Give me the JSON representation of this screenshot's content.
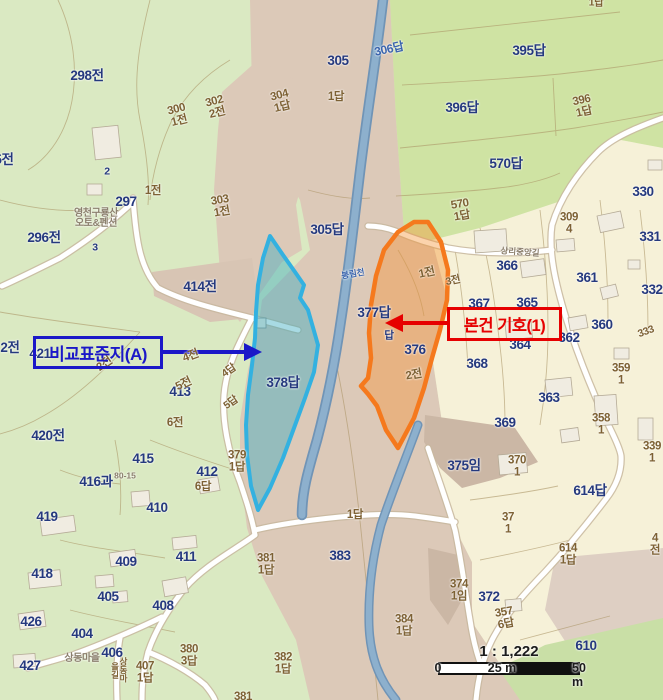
{
  "colors": {
    "navy": "#25397e",
    "brown": "#7d6134",
    "grayLabel": "#8b7f6d",
    "riverLabel": "#3a64ad",
    "calloutBlue": "#1b18c8",
    "calloutRed": "#e60000",
    "highlightOrange": "#f5791d",
    "highlightCyan": "#33b1e0",
    "paddyGreen": "#cfe3a3",
    "fieldGreen": "#dae9c2",
    "valleyTan": "#dcc9b8",
    "villageCream": "#f6f1d8",
    "riverBlue": "#84a8c6"
  },
  "callouts": {
    "comparison": {
      "label": "비교표준지(A)"
    },
    "subject": {
      "label": "본건 기호(1)"
    }
  },
  "scalebar": {
    "ratio": "1 : 1,222",
    "ticks": [
      "0",
      "25 m",
      "50 m"
    ]
  },
  "map": {
    "labels": [
      {
        "t": "298전",
        "x": 87,
        "y": 76
      },
      {
        "t": "305",
        "x": 338,
        "y": 61
      },
      {
        "t": "1답",
        "x": 336,
        "y": 98,
        "k": "brown"
      },
      {
        "t": "304\n1답",
        "x": 281,
        "y": 102,
        "k": "brown",
        "r": -14
      },
      {
        "t": "302\n2전",
        "x": 216,
        "y": 108,
        "k": "brown",
        "r": -14
      },
      {
        "t": "300\n1전",
        "x": 178,
        "y": 116,
        "k": "brown",
        "r": -14
      },
      {
        "t": "306답",
        "x": 389,
        "y": 49,
        "k": "blue",
        "r": -12
      },
      {
        "t": "395답",
        "x": 529,
        "y": 51
      },
      {
        "t": "396답",
        "x": 462,
        "y": 108
      },
      {
        "t": "396\n1답",
        "x": 583,
        "y": 107,
        "k": "brown",
        "r": -12
      },
      {
        "t": "570답",
        "x": 506,
        "y": 164
      },
      {
        "t": "570\n1답",
        "x": 461,
        "y": 211,
        "k": "brown",
        "r": -10
      },
      {
        "t": "1답",
        "x": 596,
        "y": 3,
        "k": "brown small"
      },
      {
        "t": "2",
        "x": 107,
        "y": 172,
        "k": "small"
      },
      {
        "t": "297",
        "x": 126,
        "y": 202
      },
      {
        "t": "1전",
        "x": 153,
        "y": 192,
        "k": "brown"
      },
      {
        "t": "303\n1전",
        "x": 221,
        "y": 207,
        "k": "brown",
        "r": -10
      },
      {
        "t": "영천구룡산\n오토&펜션",
        "x": 96,
        "y": 219,
        "k": "gray",
        "n": "pension-name-label"
      },
      {
        "t": "3",
        "x": 95,
        "y": 248,
        "k": "small"
      },
      {
        "t": "296전",
        "x": 44,
        "y": 238
      },
      {
        "t": "5전",
        "x": 4,
        "y": 160
      },
      {
        "t": "414전",
        "x": 200,
        "y": 287
      },
      {
        "t": "305답",
        "x": 327,
        "y": 230
      },
      {
        "t": "330",
        "x": 643,
        "y": 192
      },
      {
        "t": "331",
        "x": 650,
        "y": 237
      },
      {
        "t": "309\n4",
        "x": 569,
        "y": 224,
        "k": "brown"
      },
      {
        "t": "366",
        "x": 507,
        "y": 266
      },
      {
        "t": "361",
        "x": 587,
        "y": 278
      },
      {
        "t": "332",
        "x": 652,
        "y": 290
      },
      {
        "t": "367",
        "x": 479,
        "y": 304
      },
      {
        "t": "365",
        "x": 527,
        "y": 303
      },
      {
        "t": "377답",
        "x": 374,
        "y": 313
      },
      {
        "t": "1전",
        "x": 427,
        "y": 274,
        "k": "brown",
        "r": -12
      },
      {
        "t": "3전",
        "x": 453,
        "y": 281,
        "k": "brown small",
        "r": -12
      },
      {
        "t": "360",
        "x": 602,
        "y": 325
      },
      {
        "t": "333",
        "x": 646,
        "y": 332,
        "k": "brown small",
        "r": -20
      },
      {
        "t": "362",
        "x": 569,
        "y": 338
      },
      {
        "t": "364",
        "x": 520,
        "y": 345
      },
      {
        "t": "답",
        "x": 389,
        "y": 336,
        "k": "small"
      },
      {
        "t": "376",
        "x": 415,
        "y": 350
      },
      {
        "t": "368",
        "x": 477,
        "y": 364
      },
      {
        "t": "2전",
        "x": 414,
        "y": 376,
        "k": "brown",
        "r": -10
      },
      {
        "t": "359\n1",
        "x": 621,
        "y": 375,
        "k": "brown"
      },
      {
        "t": "378답",
        "x": 283,
        "y": 383
      },
      {
        "t": "363",
        "x": 549,
        "y": 398
      },
      {
        "t": "421",
        "x": 40,
        "y": 354
      },
      {
        "t": "2전",
        "x": 10,
        "y": 348
      },
      {
        "t": "2전",
        "x": 105,
        "y": 365,
        "k": "brown",
        "r": -35
      },
      {
        "t": "4전",
        "x": 191,
        "y": 357,
        "k": "brown",
        "r": -20
      },
      {
        "t": "4답",
        "x": 229,
        "y": 371,
        "k": "brown small",
        "r": -35
      },
      {
        "t": "413",
        "x": 180,
        "y": 392
      },
      {
        "t": "5전",
        "x": 184,
        "y": 385,
        "k": "brown",
        "r": -25
      },
      {
        "t": "5답",
        "x": 231,
        "y": 403,
        "k": "brown small",
        "r": -35
      },
      {
        "t": "6전",
        "x": 175,
        "y": 424,
        "k": "brown"
      },
      {
        "t": "420전",
        "x": 48,
        "y": 436
      },
      {
        "t": "415",
        "x": 143,
        "y": 459
      },
      {
        "t": "379\n1답",
        "x": 237,
        "y": 462,
        "k": "brown"
      },
      {
        "t": "412",
        "x": 207,
        "y": 472
      },
      {
        "t": "6답",
        "x": 203,
        "y": 488,
        "k": "brown"
      },
      {
        "t": "416과",
        "x": 96,
        "y": 482
      },
      {
        "t": "410",
        "x": 157,
        "y": 508
      },
      {
        "t": "419",
        "x": 47,
        "y": 517
      },
      {
        "t": "409",
        "x": 126,
        "y": 562
      },
      {
        "t": "411",
        "x": 186,
        "y": 557
      },
      {
        "t": "418",
        "x": 42,
        "y": 574
      },
      {
        "t": "405",
        "x": 108,
        "y": 597
      },
      {
        "t": "408",
        "x": 163,
        "y": 606
      },
      {
        "t": "426",
        "x": 31,
        "y": 622
      },
      {
        "t": "404",
        "x": 82,
        "y": 634
      },
      {
        "t": "427",
        "x": 30,
        "y": 666
      },
      {
        "t": "406",
        "x": 112,
        "y": 653
      },
      {
        "t": "상동마을",
        "x": 82,
        "y": 659,
        "k": "gray",
        "n": "village-name-label"
      },
      {
        "t": "상동마을길",
        "x": 119,
        "y": 670,
        "k": "brown tiny vert",
        "n": "road-name-label"
      },
      {
        "t": "407\n1답",
        "x": 145,
        "y": 673,
        "k": "brown"
      },
      {
        "t": "380\n3답",
        "x": 189,
        "y": 656,
        "k": "brown"
      },
      {
        "t": "382\n1답",
        "x": 283,
        "y": 664,
        "k": "brown"
      },
      {
        "t": "381",
        "x": 243,
        "y": 698,
        "k": "brown"
      },
      {
        "t": "381\n1답",
        "x": 266,
        "y": 565,
        "k": "brown"
      },
      {
        "t": "1답",
        "x": 355,
        "y": 516,
        "k": "brown"
      },
      {
        "t": "383",
        "x": 340,
        "y": 556
      },
      {
        "t": "384\n1답",
        "x": 404,
        "y": 626,
        "k": "brown"
      },
      {
        "t": "375임",
        "x": 464,
        "y": 466
      },
      {
        "t": "369",
        "x": 505,
        "y": 423
      },
      {
        "t": "370\n1",
        "x": 517,
        "y": 467,
        "k": "brown"
      },
      {
        "t": "358\n1",
        "x": 601,
        "y": 425,
        "k": "brown"
      },
      {
        "t": "339\n1",
        "x": 652,
        "y": 453,
        "k": "brown"
      },
      {
        "t": "614답",
        "x": 590,
        "y": 491
      },
      {
        "t": "614\n1답",
        "x": 568,
        "y": 555,
        "k": "brown"
      },
      {
        "t": "37\n1",
        "x": 508,
        "y": 524,
        "k": "brown"
      },
      {
        "t": "4전",
        "x": 655,
        "y": 545,
        "k": "brown"
      },
      {
        "t": "374\n1임",
        "x": 459,
        "y": 591,
        "k": "brown"
      },
      {
        "t": "372",
        "x": 489,
        "y": 597
      },
      {
        "t": "357\n6답",
        "x": 505,
        "y": 619,
        "k": "brown",
        "r": -10
      },
      {
        "t": "610",
        "x": 586,
        "y": 646
      },
      {
        "t": "상리중앙길",
        "x": 520,
        "y": 252,
        "k": "gray tiny",
        "r": 4,
        "n": "road-name-label"
      },
      {
        "t": "봉림천",
        "x": 353,
        "y": 274,
        "k": "blue tiny",
        "r": -10,
        "n": "stream-name-label"
      },
      {
        "t": "80-15",
        "x": 125,
        "y": 476,
        "k": "gray tiny"
      }
    ]
  }
}
